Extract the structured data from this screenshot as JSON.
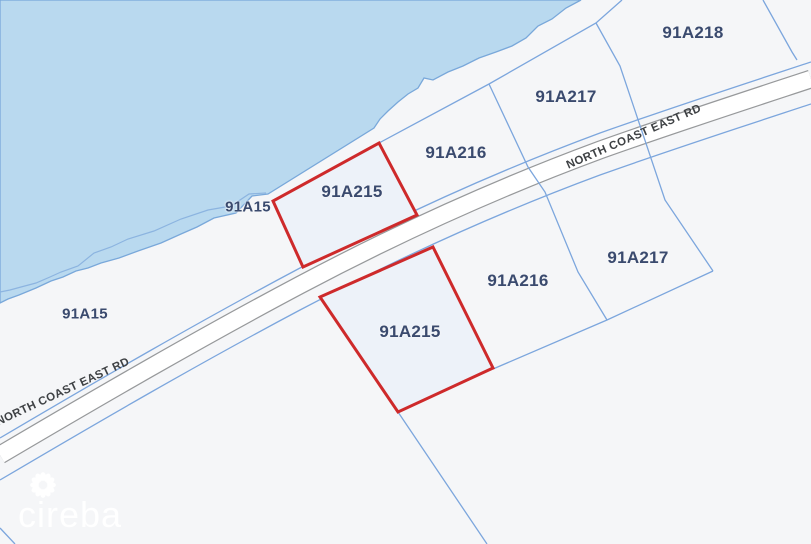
{
  "map": {
    "kind": "cadastral-parcel-map",
    "road": {
      "name": "NORTH COAST EAST RD",
      "label_instances": 2
    },
    "parcel_labels": [
      {
        "text": "91A215",
        "location": "above-road",
        "highlighted": true
      },
      {
        "text": "91A216",
        "location": "above-road",
        "highlighted": false
      },
      {
        "text": "91A217",
        "location": "above-road",
        "highlighted": false
      },
      {
        "text": "91A218",
        "location": "above-road",
        "highlighted": false
      },
      {
        "text": "91A215",
        "location": "below-road",
        "highlighted": true
      },
      {
        "text": "91A216",
        "location": "below-road",
        "highlighted": false
      },
      {
        "text": "91A217",
        "location": "below-road",
        "highlighted": false
      },
      {
        "text": "91A15",
        "location": "coastal-strip-east",
        "highlighted": false
      },
      {
        "text": "91A15",
        "location": "coastal-strip-west",
        "highlighted": false
      }
    ],
    "colors": {
      "water": "#b9d9ef",
      "land": "#f5f6f8",
      "parcel_line_blue": "#7ca6dd",
      "coastline_blue": "#79a8da",
      "road_fill": "#ffffff",
      "road_casing": "#97999b",
      "highlight_red": "#ce2a2b",
      "highlight_fill": "#edf2f9",
      "parcel_label_navy": "#3a4a6e",
      "road_label_gray": "#3e4144"
    },
    "watermark": {
      "text": "cireba",
      "logo": "petal-ring"
    }
  }
}
